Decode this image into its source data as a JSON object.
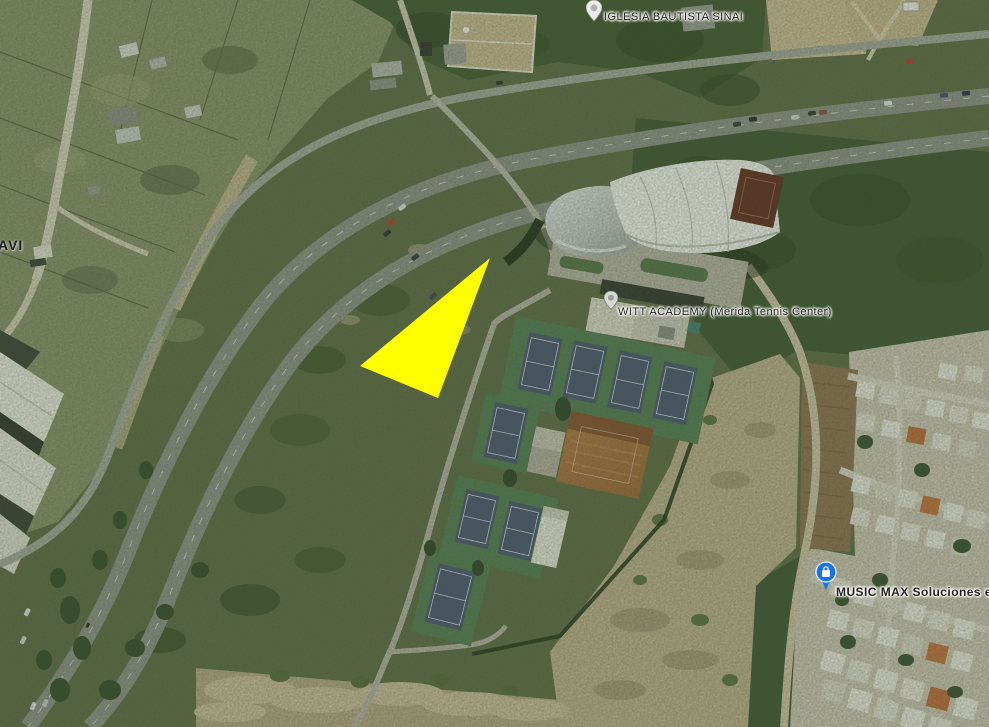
{
  "map": {
    "view": "satellite",
    "labels": {
      "church": {
        "text": "IGLESIA BAUTISTA SINAI"
      },
      "tennis_center": {
        "text": "WITT ACADEMY (Merida Tennis Center)"
      },
      "store": {
        "text": "MUSIC MAX Soluciones en"
      },
      "street_partial": {
        "text": "AVI"
      }
    },
    "pins": {
      "church": {
        "icon": "teardrop-pin",
        "color": "#ececea"
      },
      "tennis_center": {
        "icon": "teardrop-pin",
        "color": "#d8d8d5"
      },
      "store": {
        "icon": "shopping-bag-pin",
        "color": "#1a73e8"
      }
    },
    "marker": {
      "shape": "triangle",
      "color": "#ffff00"
    }
  }
}
